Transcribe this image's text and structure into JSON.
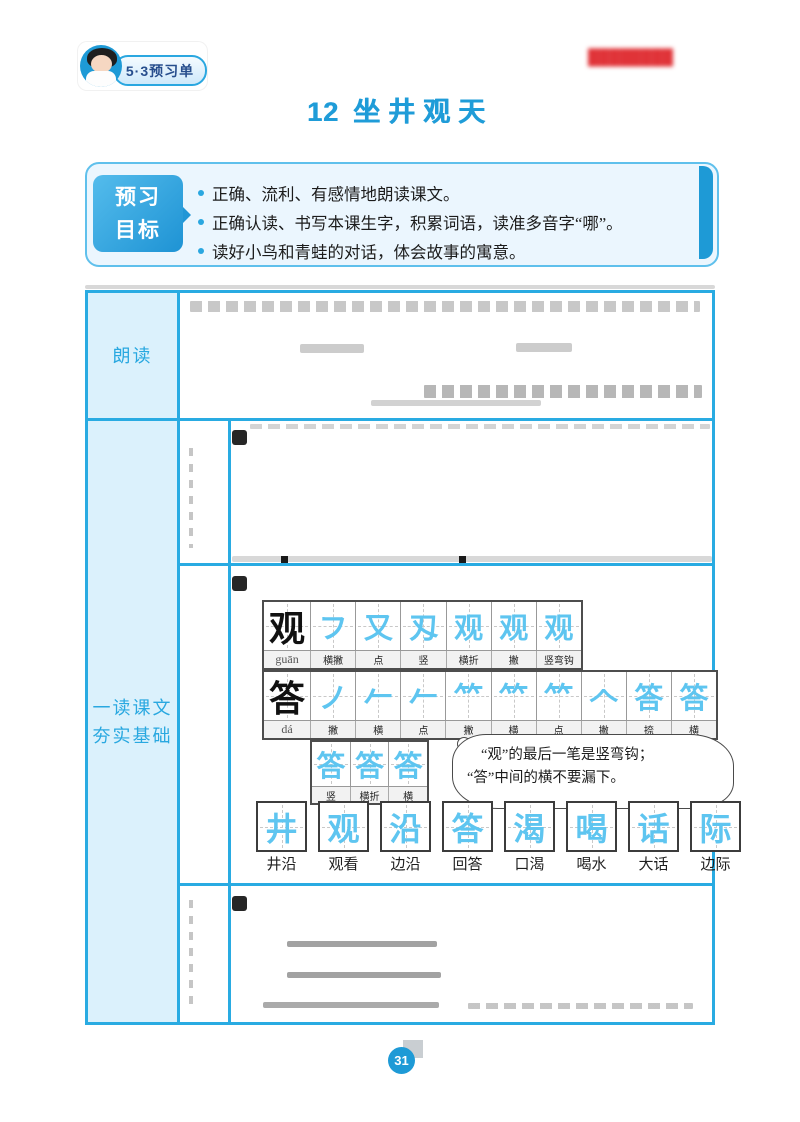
{
  "colors": {
    "accent_blue": "#29abe2",
    "title_blue": "#1f9cd8",
    "cell_bg_blue": "#dbf1fc",
    "stroke_glyph_blue": "#5ec5f0",
    "watermark_red": "#e03338"
  },
  "header": {
    "series_badge": "5·3预习单",
    "watermark_text": "████████",
    "lesson_number": "12",
    "lesson_title": "坐井观天"
  },
  "goals": {
    "tab_line1": "预习",
    "tab_line2": "目标",
    "items": [
      "正确、流利、有感情地朗读课文。",
      "正确认读、书写本课生字，积累词语，读准多音字“哪”。",
      "读好小鸟和青蛙的对话，体会故事的寓意。"
    ]
  },
  "table": {
    "row1_label": "朗读",
    "row2_label_line1": "一读课文",
    "row2_label_line2": "夯实基础",
    "guan": {
      "char": "观",
      "pinyin": "guān",
      "stages": [
        "フ",
        "又",
        "刄",
        "观",
        "观",
        "观"
      ],
      "strokes": [
        "横撇",
        "点",
        "竖",
        "横折",
        "撇",
        "竖弯钩"
      ]
    },
    "da": {
      "char": "答",
      "pinyin": "dá",
      "stages": [
        "ノ",
        "𠂉",
        "𠂉",
        "𥫗",
        "𥫗",
        "𥫗",
        "𠆢",
        "答",
        "答"
      ],
      "strokes": [
        "撇",
        "横",
        "点",
        "撇",
        "横",
        "点",
        "撇",
        "捺",
        "横"
      ]
    },
    "da_cont": {
      "stages": [
        "答",
        "答",
        "答"
      ],
      "strokes": [
        "竖",
        "横折",
        "横"
      ]
    },
    "tip": {
      "line1": "“观”的最后一笔是竖弯钩；",
      "line2": "“答”中间的横不要漏下。"
    },
    "practice": {
      "chars": [
        "井",
        "观",
        "沿",
        "答",
        "渴",
        "喝",
        "话",
        "际"
      ],
      "words": [
        "井沿",
        "观看",
        "边沿",
        "回答",
        "口渴",
        "喝水",
        "大话",
        "边际"
      ]
    }
  },
  "footer": {
    "page_number": "31"
  }
}
